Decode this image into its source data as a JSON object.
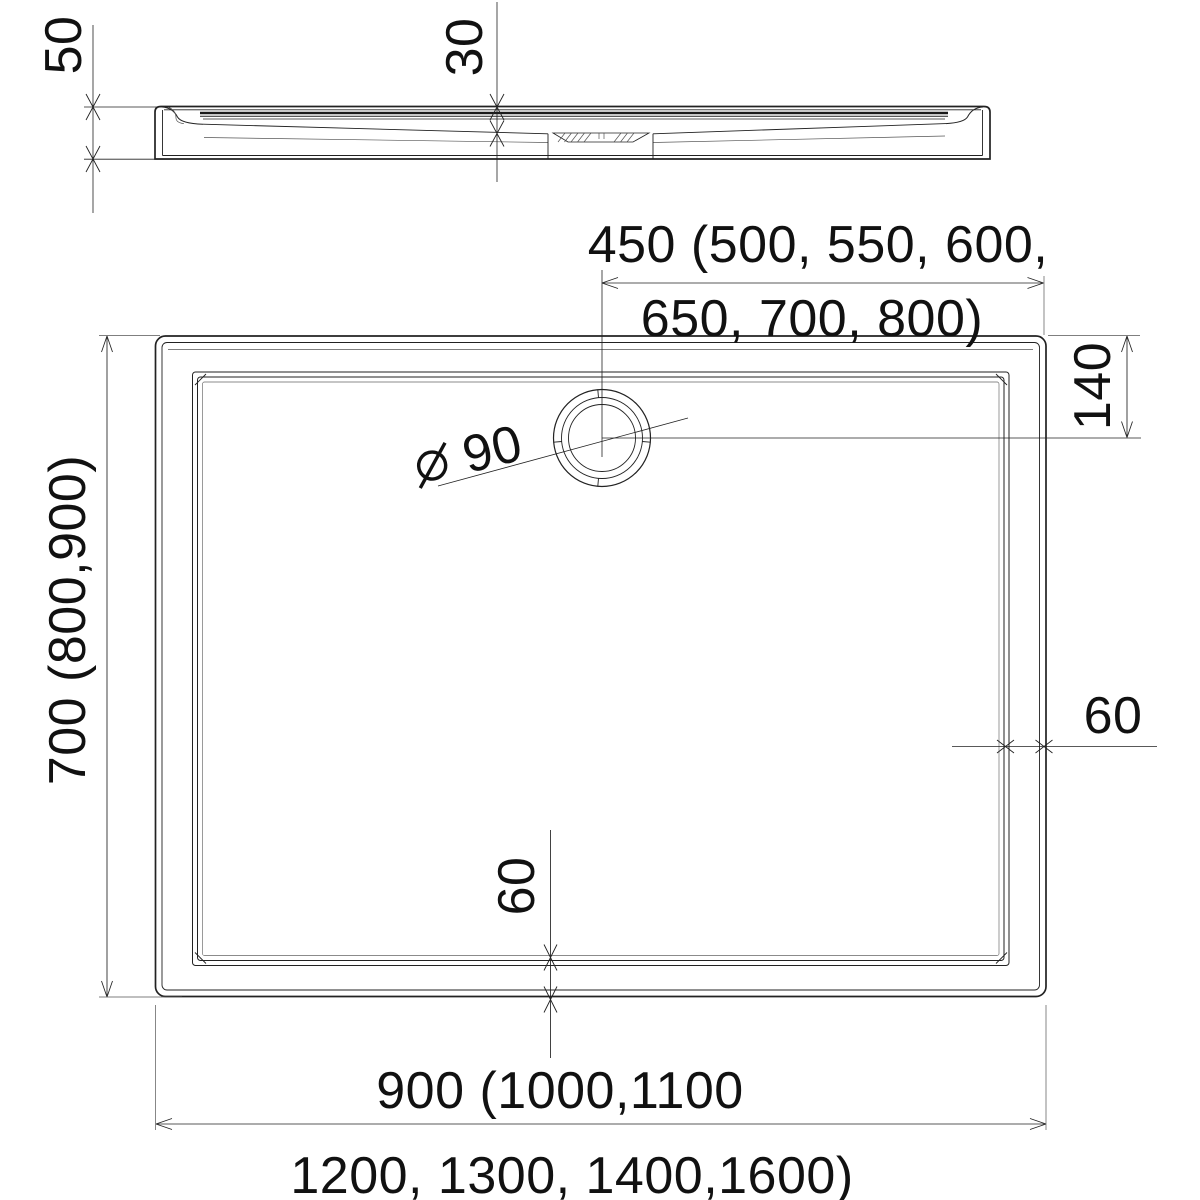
{
  "document": {
    "type": "technical-drawing",
    "subject": "rectangular shower tray with corner drain, plan and side views",
    "background": "#ffffff",
    "line_color": "#222222",
    "text_color": "#111111"
  },
  "dimensions": {
    "side_height": "50",
    "side_depth": "30",
    "top_width_line1": "450 (500, 550, 600,",
    "top_width_line2": "650, 700, 800)",
    "drain_offset": "140",
    "drain_diameter_symbol": "⌀",
    "drain_diameter_value": "90",
    "left_height": "700 (800,900)",
    "rim_right": "60",
    "rim_bottom": "60",
    "bottom_width_line1": "900 (1000,1100",
    "bottom_width_line2": "1200, 1300, 1400,1600)"
  }
}
